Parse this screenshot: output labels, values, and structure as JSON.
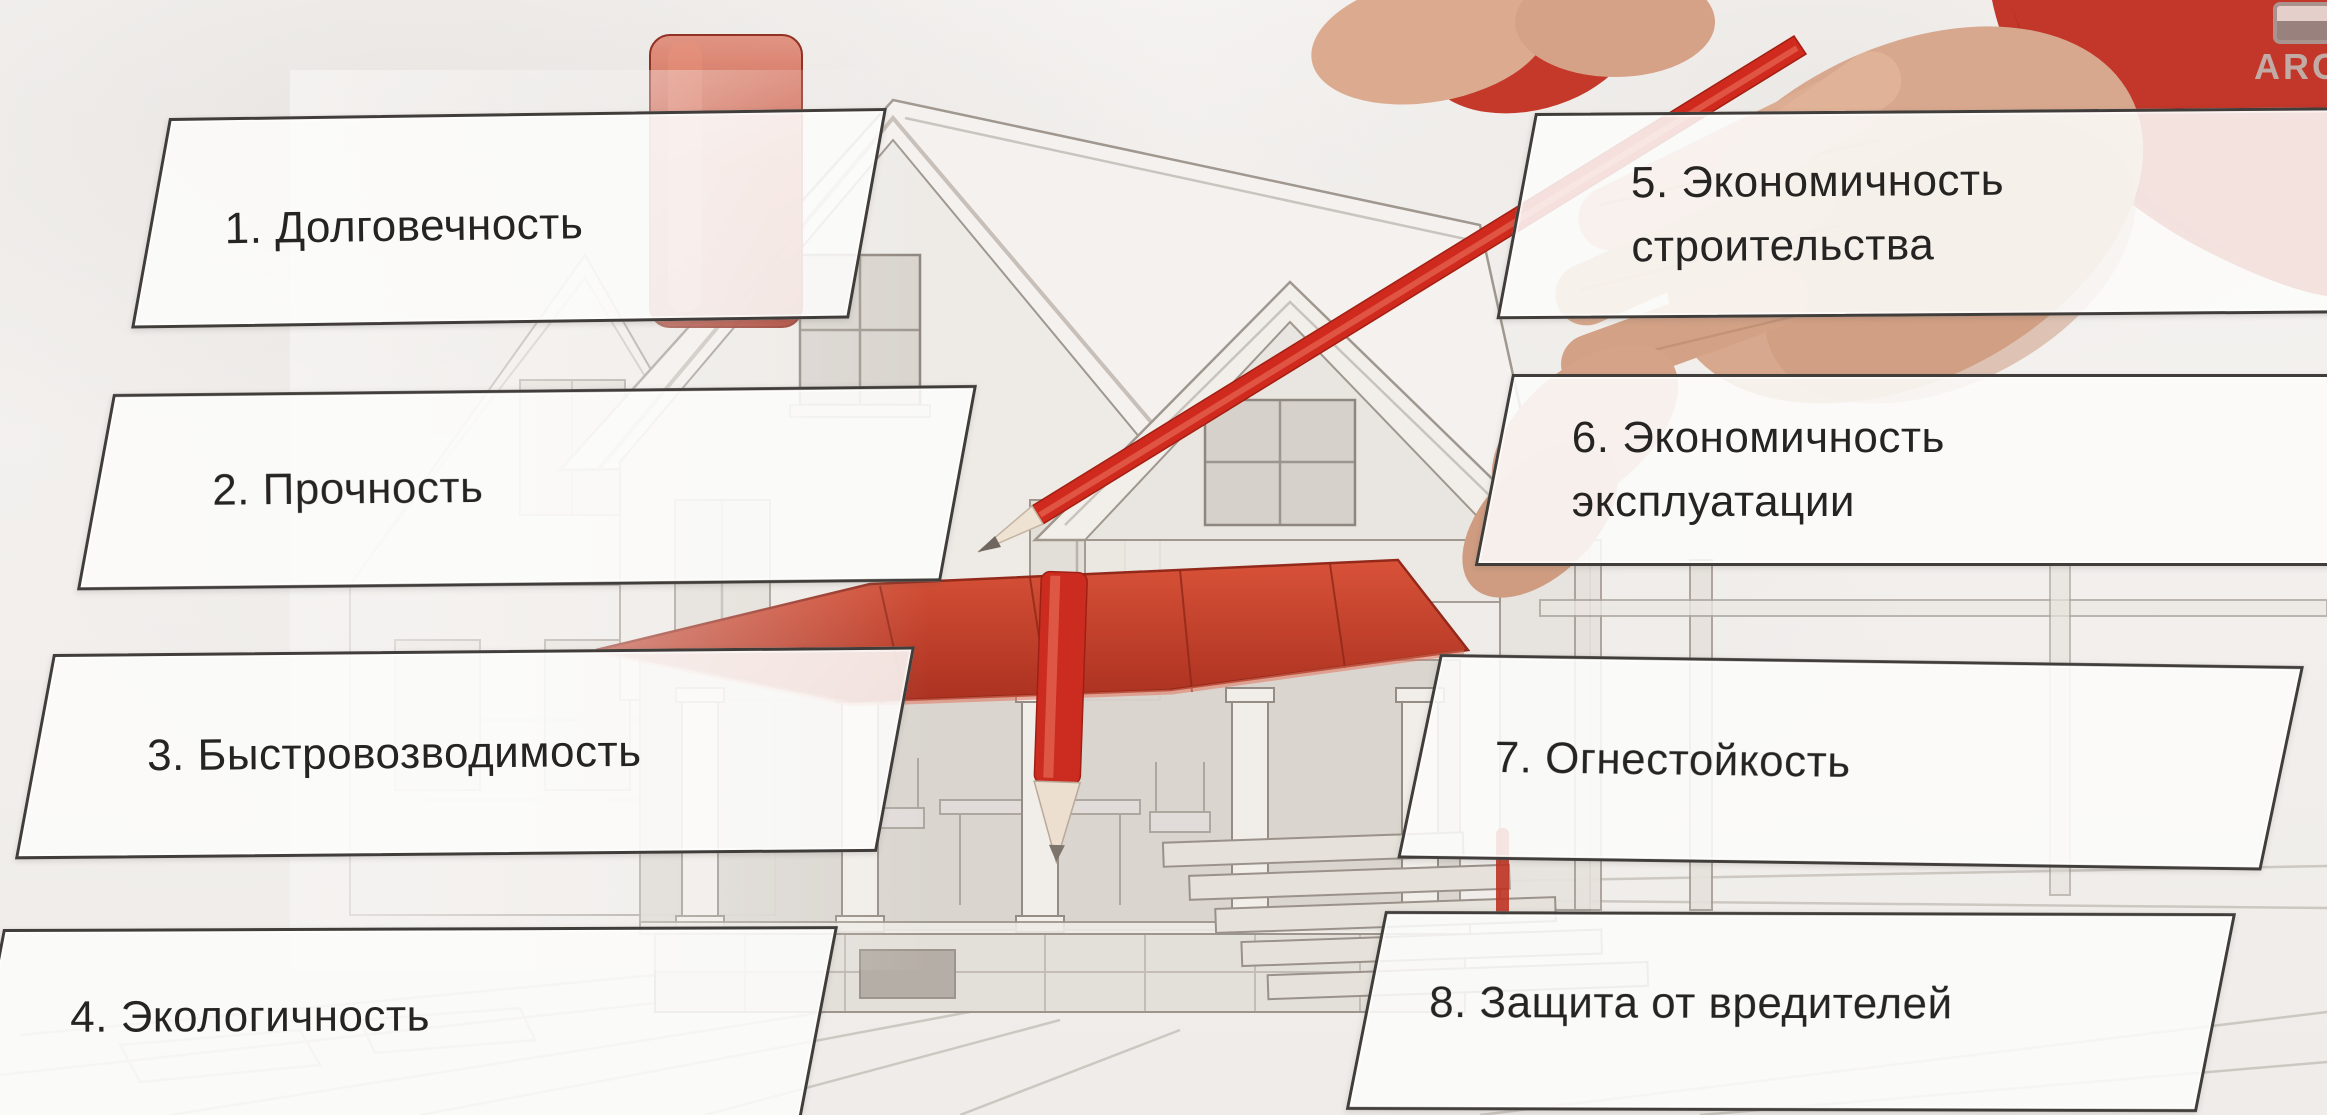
{
  "watermark": {
    "text": "ARC",
    "icon": "logo-badge-icon",
    "text_color": "#c2bfbb"
  },
  "colors": {
    "background": "#f3f1ee",
    "box_border": "#403d3a",
    "box_fill": "rgba(252,251,250,0.87)",
    "label_text": "#262422",
    "accent_red": "#c53a28",
    "sketch_line": "#9b938b"
  },
  "labels": [
    {
      "id": 1,
      "lines": [
        "1. Долговечность"
      ]
    },
    {
      "id": 2,
      "lines": [
        "2. Прочность"
      ]
    },
    {
      "id": 3,
      "lines": [
        "3. Быстровозводимость"
      ]
    },
    {
      "id": 4,
      "lines": [
        "4. Экологичность"
      ]
    },
    {
      "id": 5,
      "lines": [
        "5. Экономичность",
        "строительства"
      ]
    },
    {
      "id": 6,
      "lines": [
        "6. Экономичность",
        "эксплуатации"
      ]
    },
    {
      "id": 7,
      "lines": [
        "7. Огнестойкость"
      ]
    },
    {
      "id": 8,
      "lines": [
        "8. Защита от вредителей"
      ]
    }
  ],
  "illustration": {
    "subject": "pencil-sketch house being drawn by a hand in a red sleeve holding a red pencil",
    "elements": [
      "house-sketch",
      "red-chimney",
      "red-porch-awning",
      "porch-columns",
      "stairs",
      "drawing-hand",
      "held-red-pencil",
      "standing-red-pencil"
    ]
  }
}
